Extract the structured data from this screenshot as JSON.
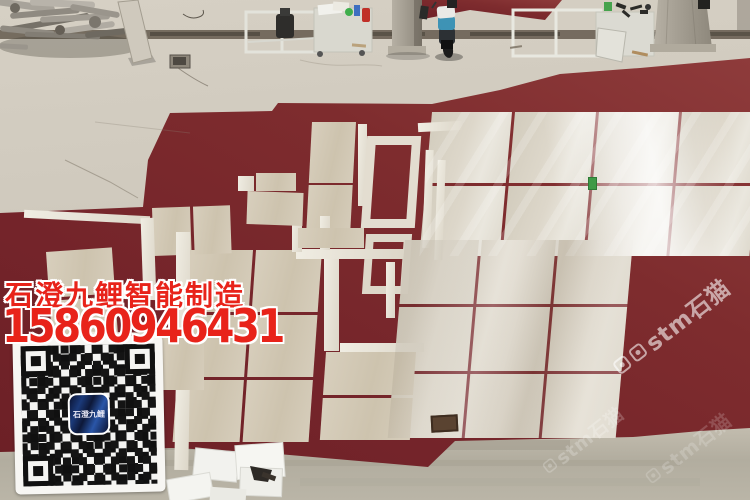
{
  "overlay": {
    "company_name": "石澄九鲤智能制造",
    "phone_number": "15860946431",
    "text_color": "#e8231a"
  },
  "watermarks": {
    "brand": "stm石猫",
    "icons": [
      "social-app-icon-1",
      "social-app-icon-2"
    ],
    "color": "rgba(255,255,255,0.58)"
  },
  "qr": {
    "center_logo_text": "石澄九鲤"
  },
  "colors": {
    "carpet_red": "#7c2a2c",
    "carpet_red_light": "#8e3b3b",
    "tile_beige": "#d5ccba",
    "tile_bright": "#efece2",
    "concrete_grey": "#ccc6b9",
    "concrete_dark": "#aaa496",
    "groove_brown": "#695f51",
    "qr_logo_navy": "#16295e",
    "scooter_teal": "#3e93b5",
    "extinguisher_red": "#c03028",
    "sticker_green": "#3f9a47"
  },
  "scene_objects": [
    "red-carpet",
    "marble-tile-layout",
    "scrap-metal-pile",
    "leaning-slab",
    "work-table-1",
    "work-table-2",
    "concrete-pillar-1",
    "concrete-pillar-2",
    "scooter",
    "floor-drain",
    "paper-sheets",
    "hand-tool",
    "qr-code"
  ]
}
